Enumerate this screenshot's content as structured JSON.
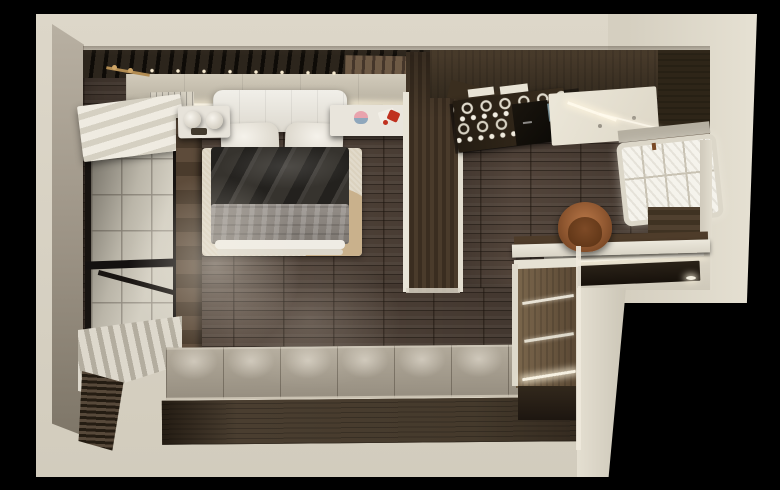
{
  "scene": {
    "label": "Top-down 3D render of a compact studio apartment with bedroom, kitchenette and entry steps, L-shaped cream shell on black background",
    "rooms": [
      "bedroom",
      "kitchenette",
      "entry",
      "tiled balcony"
    ]
  },
  "objects": {
    "shell": {
      "label": "Cream outer walls, L-shaped floor plan"
    },
    "bedroom_floor": {
      "label": "Dark wood plank floor"
    },
    "headboard_wall": {
      "label": "Dark slatted headboard wall with LED cove light and brass rail"
    },
    "left_window": {
      "label": "Black-framed window onto white-tiled balcony"
    },
    "roller_blind": {
      "label": "White roller blind"
    },
    "blind_stack": {
      "label": "Folded wood venetian blind stack"
    },
    "bed": {
      "label": "Double bed"
    },
    "headboard": {
      "label": "White upholstered headboard"
    },
    "pillows": {
      "label": "Two white pillows"
    },
    "duvet": {
      "label": "Charcoal duvet"
    },
    "blanket": {
      "label": "Grey throw blanket"
    },
    "mattress": {
      "label": "White mattress edge"
    },
    "rug": {
      "label": "Cream textured rug with tan round insert"
    },
    "nightstand": {
      "label": "White nightstand with two globe lamps"
    },
    "side_table": {
      "label": "White side table with pink and red decor"
    },
    "wardrobe": {
      "label": "Dark wood wardrobe partition with white edges"
    },
    "kitchen_cabinets": {
      "label": "Dark wood upper kitchen cabinets"
    },
    "glass_rack": {
      "label": "Hanging wine-glass rack with two rows of glasses"
    },
    "hood": {
      "label": "Black extractor hood"
    },
    "ceiling_lights": {
      "label": "White ceiling panel with recessed downlights and LED tubes"
    },
    "right_window": {
      "label": "White gridded window, right wall"
    },
    "desk": {
      "label": "White desk worktop"
    },
    "chair": {
      "label": "Cognac leather chair"
    },
    "entry": {
      "label": "Entry landing with dark step and LED strips"
    },
    "counter": {
      "label": "Wood cabinet column with lit handle strips"
    },
    "platform": {
      "label": "Grey plank platform with wall-washer light pools and dark wood face"
    }
  },
  "palette": {
    "background": "#000000",
    "wall_cream": "#d8d2c3",
    "wall_face_greige": "#a59d8f",
    "floor_wood": "#52443a",
    "floor_wood_dark": "#3a2f25",
    "headboard_panel": "#c9c2b2",
    "bed_white": "#eae7e0",
    "duvet_charcoal": "#36332e",
    "blanket_grey": "#8b8580",
    "rug_cream": "#dbd2bf",
    "rug_tan": "#c9b18c",
    "chair_cognac": "#9a5f33",
    "step_dark": "#241d15",
    "entry_floor": "#d8d2c4",
    "platform_top": "#a39a8c",
    "platform_face": "#40352a",
    "cabinet_wood": "#6f5c45",
    "window_pane": "#f4f2ea",
    "balcony_tile": "#d0cbbd",
    "teal_glass": "#7e99a2",
    "led_warm": "#fff8e8",
    "red_accent": "#c0311f",
    "pink_accent": "#e8a3ad",
    "brass": "#b28c52"
  }
}
